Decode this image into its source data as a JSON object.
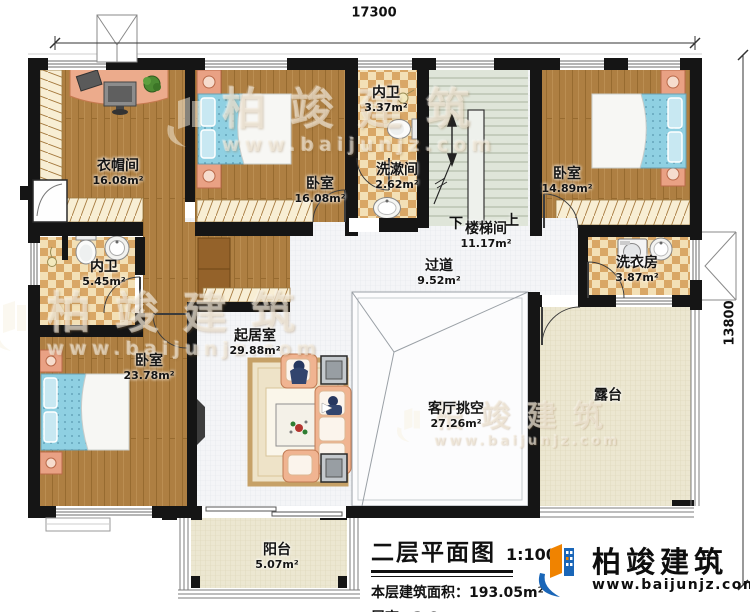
{
  "dimensions": {
    "width_label": "17300",
    "height_label": "13800"
  },
  "stairs": {
    "down": "下",
    "up": "上"
  },
  "rooms": [
    {
      "id": "cloakroom",
      "name": "衣帽间",
      "area": "16.08m²"
    },
    {
      "id": "bedroom-top",
      "name": "卧室",
      "area": "16.08m²"
    },
    {
      "id": "bath-small",
      "name": "内卫",
      "area": "3.37m²"
    },
    {
      "id": "washroom",
      "name": "洗漱间",
      "area": "2.62m²"
    },
    {
      "id": "stairwell",
      "name": "楼梯间",
      "area": "11.17m²"
    },
    {
      "id": "bedroom-right",
      "name": "卧室",
      "area": "14.89m²"
    },
    {
      "id": "laundry",
      "name": "洗衣房",
      "area": "3.87m²"
    },
    {
      "id": "bath-left",
      "name": "内卫",
      "area": "5.45m²"
    },
    {
      "id": "hallway",
      "name": "过道",
      "area": "9.52m²"
    },
    {
      "id": "living",
      "name": "起居室",
      "area": "29.88m²"
    },
    {
      "id": "bedroom-bottom",
      "name": "卧室",
      "area": "23.78m²"
    },
    {
      "id": "void",
      "name": "客厅挑空",
      "area": "27.26m²"
    },
    {
      "id": "terrace",
      "name": "露台",
      "area": ""
    },
    {
      "id": "balcony",
      "name": "阳台",
      "area": "5.07m²"
    }
  ],
  "title_block": {
    "title": "二层平面图",
    "scale": "1:100",
    "area_label": "本层建筑面积：",
    "area_value": "193.05m²",
    "height_label": "层高：",
    "height_value": "3.6m"
  },
  "logo": {
    "name": "柏竣建筑",
    "url": "www.baijunjz.com"
  },
  "watermark": {
    "name": "柏竣建筑",
    "url": "www.baijunjz.com"
  },
  "colors": {
    "wall": "#151515",
    "wood": "#ae7f42",
    "tile_check": "#d9a766",
    "stair_floor": "#dfe5d9",
    "terrace_floor": "#ece7d1",
    "bed": "#8fd0e2",
    "furniture": "#f0b491",
    "logo_blue": "#1a66b8",
    "logo_orange": "#f08300"
  }
}
